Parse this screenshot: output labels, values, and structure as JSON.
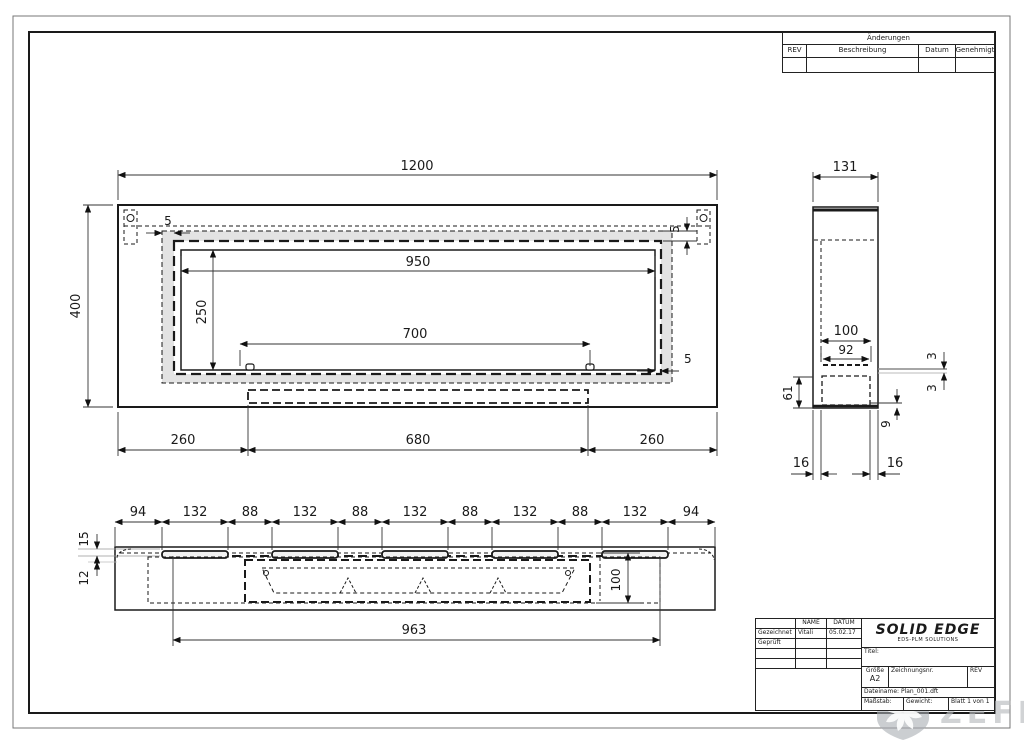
{
  "sheet": {
    "changes": {
      "title": "Änderungen",
      "columns": [
        "REV",
        "Beschreibung",
        "Datum",
        "Genehmigt"
      ]
    },
    "title_block": {
      "name_col": "NAME",
      "date_col": "DATUM",
      "rows": [
        {
          "label": "Gezeichnet",
          "name": "Vitali",
          "date": "05.02.17"
        },
        {
          "label": "Geprüft",
          "name": "",
          "date": ""
        }
      ],
      "brand": "SOLID EDGE",
      "brand_sub": "EDS-PLM SOLUTIONS",
      "title_label": "Titel:",
      "size_label": "Größe",
      "size_value": "A2",
      "dwg_no_label": "Zeichnungsnr.",
      "rev_label": "REV",
      "file_label": "Dateiname: Plan_001.dft",
      "scale_label": "Maßstab:",
      "weight_label": "Gewicht:",
      "sheet_label": "Blatt 1 von 1"
    },
    "watermark_text": "ZEFIRE"
  },
  "views": {
    "front": {
      "overall_width": "1200",
      "overall_height": "400",
      "opening_width": "950",
      "opening_height": "250",
      "burner_width": "700",
      "bottom_left": "260",
      "bottom_center": "680",
      "bottom_right": "260",
      "gap_top_left": "5",
      "gap_top_right": "5",
      "gap_bottom_right": "5"
    },
    "side": {
      "overall_width": "131",
      "slot_outer": "100",
      "slot_inner": "92",
      "plate_top": "3",
      "plate_bottom": "3",
      "box_depth": "61",
      "flange_drop": "9",
      "foot_left": "16",
      "foot_right": "16"
    },
    "bottom": {
      "segments": [
        "94",
        "132",
        "88",
        "132",
        "88",
        "132",
        "88",
        "132",
        "88",
        "132",
        "94"
      ],
      "lip_top": "15",
      "lip_bottom": "12",
      "slot_height": "100",
      "overall": "963"
    }
  }
}
